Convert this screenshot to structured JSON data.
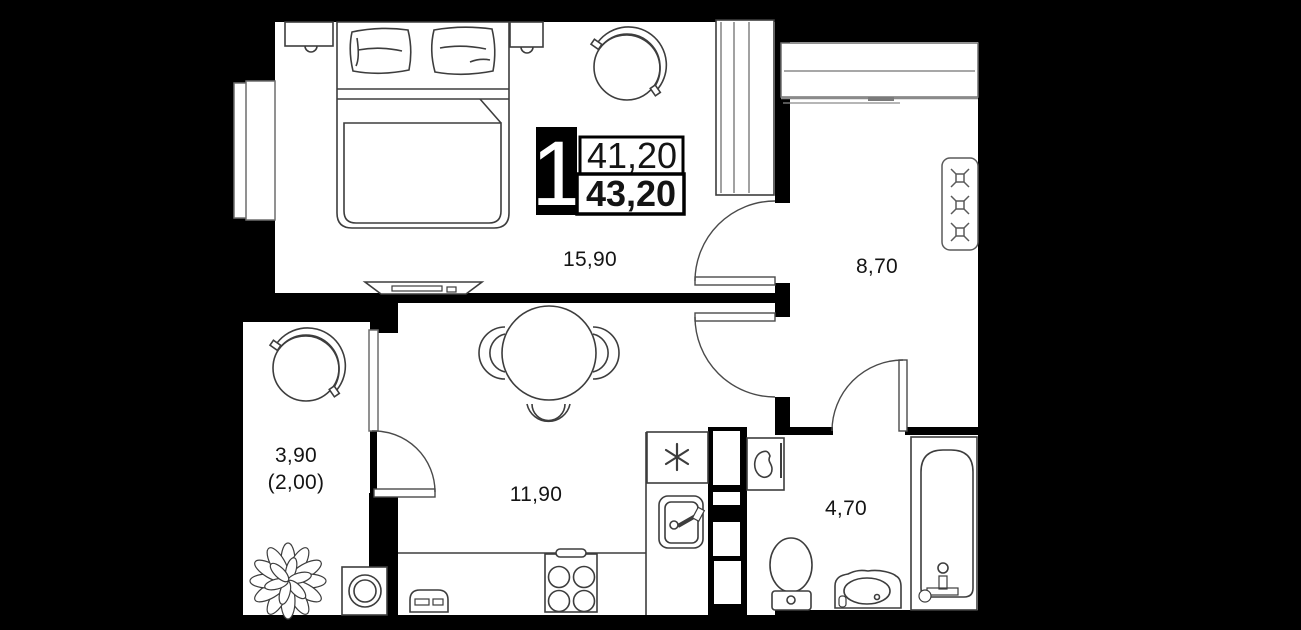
{
  "floorplan": {
    "unit_badge": {
      "rooms_count": "1",
      "living_area": "41,20",
      "total_area": "43,20"
    },
    "room_areas": {
      "bedroom": "15,90",
      "hallway": "8,70",
      "kitchen_living": "11,90",
      "balcony": "3,90",
      "balcony_reduced": "(2,00)",
      "bathroom": "4,70"
    },
    "colors": {
      "background": "#000000",
      "floor": "#ffffff",
      "furniture_line": "#3d3d3d",
      "light_line": "#8a8a8a",
      "text": "#141414",
      "badge_block": "#000000"
    }
  }
}
